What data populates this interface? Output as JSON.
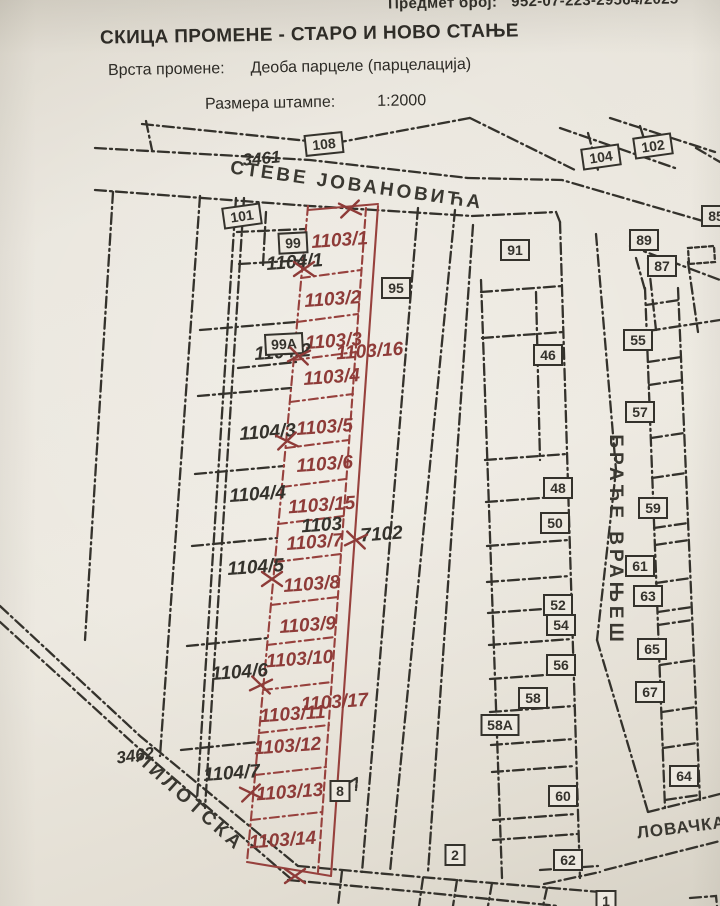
{
  "header": {
    "case_label": "Предмет број:",
    "case_number": "952-07-223-29564/2025",
    "title": "СКИЦА ПРОМЕНЕ - СТАРО И НОВО СТАЊЕ",
    "change_type_label": "Врста промене:",
    "change_type_value": "Деоба парцеле (парцелација)",
    "scale_label": "Размера штампе:",
    "scale_value": "1:2000"
  },
  "map": {
    "colors": {
      "new_parcel": "#8e3b38",
      "old_lines": "#34322c",
      "paper": "#e9e5dc"
    },
    "new_parcel_labels": [
      {
        "t": "1103/1",
        "x": 340,
        "y": 246
      },
      {
        "t": "1103/2",
        "x": 333,
        "y": 305
      },
      {
        "t": "1103/3",
        "x": 334,
        "y": 347
      },
      {
        "t": "1103/16",
        "x": 370,
        "y": 357
      },
      {
        "t": "1103/4",
        "x": 332,
        "y": 383
      },
      {
        "t": "1103/5",
        "x": 325,
        "y": 433
      },
      {
        "t": "1103/6",
        "x": 325,
        "y": 470
      },
      {
        "t": "1103/15",
        "x": 322,
        "y": 511
      },
      {
        "t": "1103/7",
        "x": 315,
        "y": 548
      },
      {
        "t": "1103/8",
        "x": 312,
        "y": 590
      },
      {
        "t": "1103/9",
        "x": 308,
        "y": 631
      },
      {
        "t": "1103/10",
        "x": 300,
        "y": 665
      },
      {
        "t": "1103/17",
        "x": 335,
        "y": 708
      },
      {
        "t": "1103/11",
        "x": 293,
        "y": 720
      },
      {
        "t": "1103/12",
        "x": 288,
        "y": 752
      },
      {
        "t": "1103/13",
        "x": 290,
        "y": 798
      },
      {
        "t": "1103/14",
        "x": 283,
        "y": 846
      }
    ],
    "old_parcel_labels": [
      {
        "t": "1104/1",
        "x": 295,
        "y": 268
      },
      {
        "t": "1104/2",
        "x": 283,
        "y": 358
      },
      {
        "t": "1104/3",
        "x": 268,
        "y": 438
      },
      {
        "t": "1104/4",
        "x": 258,
        "y": 500
      },
      {
        "t": "1104/5",
        "x": 256,
        "y": 573
      },
      {
        "t": "1104/6",
        "x": 240,
        "y": 678
      },
      {
        "t": "1104/7",
        "x": 232,
        "y": 779
      },
      {
        "t": "1103",
        "x": 322,
        "y": 531
      },
      {
        "t": "7102",
        "x": 382,
        "y": 540
      },
      {
        "t": "3461",
        "x": 262,
        "y": 164,
        "rot": -5,
        "s": 17
      },
      {
        "t": "3462",
        "x": 136,
        "y": 761,
        "rot": -8,
        "s": 17
      }
    ],
    "house_numbers": [
      {
        "t": "108",
        "x": 324,
        "y": 144,
        "rot": -6
      },
      {
        "t": "104",
        "x": 601,
        "y": 157,
        "rot": -8
      },
      {
        "t": "102",
        "x": 653,
        "y": 146,
        "rot": -8
      },
      {
        "t": "101",
        "x": 242,
        "y": 216,
        "rot": -8
      },
      {
        "t": "99",
        "x": 293,
        "y": 243,
        "rot": -3
      },
      {
        "t": "99А",
        "x": 284,
        "y": 344,
        "rot": -3
      },
      {
        "t": "95",
        "x": 396,
        "y": 288
      },
      {
        "t": "91",
        "x": 515,
        "y": 250
      },
      {
        "t": "89",
        "x": 644,
        "y": 240
      },
      {
        "t": "87",
        "x": 662,
        "y": 266
      },
      {
        "t": "85",
        "x": 716,
        "y": 216
      },
      {
        "t": "46",
        "x": 548,
        "y": 355
      },
      {
        "t": "55",
        "x": 638,
        "y": 340
      },
      {
        "t": "57",
        "x": 640,
        "y": 412
      },
      {
        "t": "48",
        "x": 558,
        "y": 488
      },
      {
        "t": "50",
        "x": 555,
        "y": 523
      },
      {
        "t": "59",
        "x": 653,
        "y": 508
      },
      {
        "t": "61",
        "x": 640,
        "y": 566
      },
      {
        "t": "63",
        "x": 648,
        "y": 596
      },
      {
        "t": "52",
        "x": 558,
        "y": 605
      },
      {
        "t": "54",
        "x": 561,
        "y": 625
      },
      {
        "t": "65",
        "x": 652,
        "y": 649
      },
      {
        "t": "56",
        "x": 561,
        "y": 665
      },
      {
        "t": "67",
        "x": 650,
        "y": 692
      },
      {
        "t": "58",
        "x": 533,
        "y": 698
      },
      {
        "t": "58А",
        "x": 500,
        "y": 725
      },
      {
        "t": "64",
        "x": 684,
        "y": 776
      },
      {
        "t": "60",
        "x": 563,
        "y": 796
      },
      {
        "t": "8",
        "x": 340,
        "y": 791
      },
      {
        "t": "62",
        "x": 568,
        "y": 860
      },
      {
        "t": "2",
        "x": 455,
        "y": 855
      },
      {
        "t": "1",
        "x": 606,
        "y": 901
      }
    ],
    "street_labels": [
      {
        "t": "СТЕВЕ ЈОВАНОВИЋА",
        "x": 356,
        "y": 191,
        "rot": 8,
        "s": 19,
        "ls": 3
      },
      {
        "t": "БРАЋЕ ВРАЊЕШ",
        "x": 610,
        "y": 540,
        "rot": 90,
        "s": 19,
        "ls": 4
      },
      {
        "t": "ПИЛОТСКА",
        "x": 186,
        "y": 806,
        "rot": 42,
        "s": 19,
        "ls": 4
      },
      {
        "t": "ЛОВАЧКА",
        "x": 682,
        "y": 833,
        "rot": -7,
        "s": 17,
        "ls": 1
      }
    ],
    "survey_marks": [
      [
        350,
        209
      ],
      [
        304,
        269
      ],
      [
        299,
        356
      ],
      [
        287,
        441
      ],
      [
        272,
        579
      ],
      [
        261,
        685
      ],
      [
        251,
        793
      ],
      [
        295,
        876
      ],
      [
        356,
        540
      ]
    ]
  }
}
